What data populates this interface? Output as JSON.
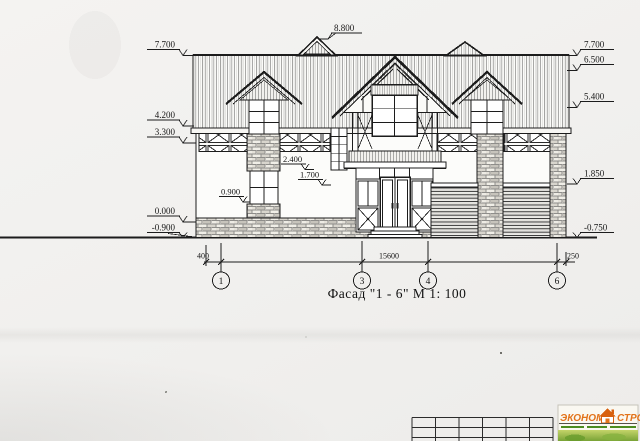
{
  "drawing": {
    "title": "Фасад \"1 - 6\"  М  1: 100",
    "marks": {
      "top": "8.800",
      "left": [
        "7.700",
        "4.200",
        "3.300",
        "0.000",
        "-0.900"
      ],
      "right": [
        "7.700",
        "6.500",
        "5.400",
        "1.850",
        "-0.750"
      ],
      "inner": [
        "2.400",
        "1.700",
        "0.900"
      ]
    },
    "dims": {
      "left_offset": "400",
      "total": "15600",
      "right_offset": "250"
    },
    "axes": [
      "1",
      "3",
      "4",
      "6"
    ]
  },
  "logo": {
    "word1": "ЭКОНОМ",
    "word2": "СТРОЙ"
  },
  "colors": {
    "line": "#1c1c1c",
    "paper": "#f1f0ee",
    "logo_orange": "#e2731a",
    "logo_green": "#5f9e2c"
  }
}
